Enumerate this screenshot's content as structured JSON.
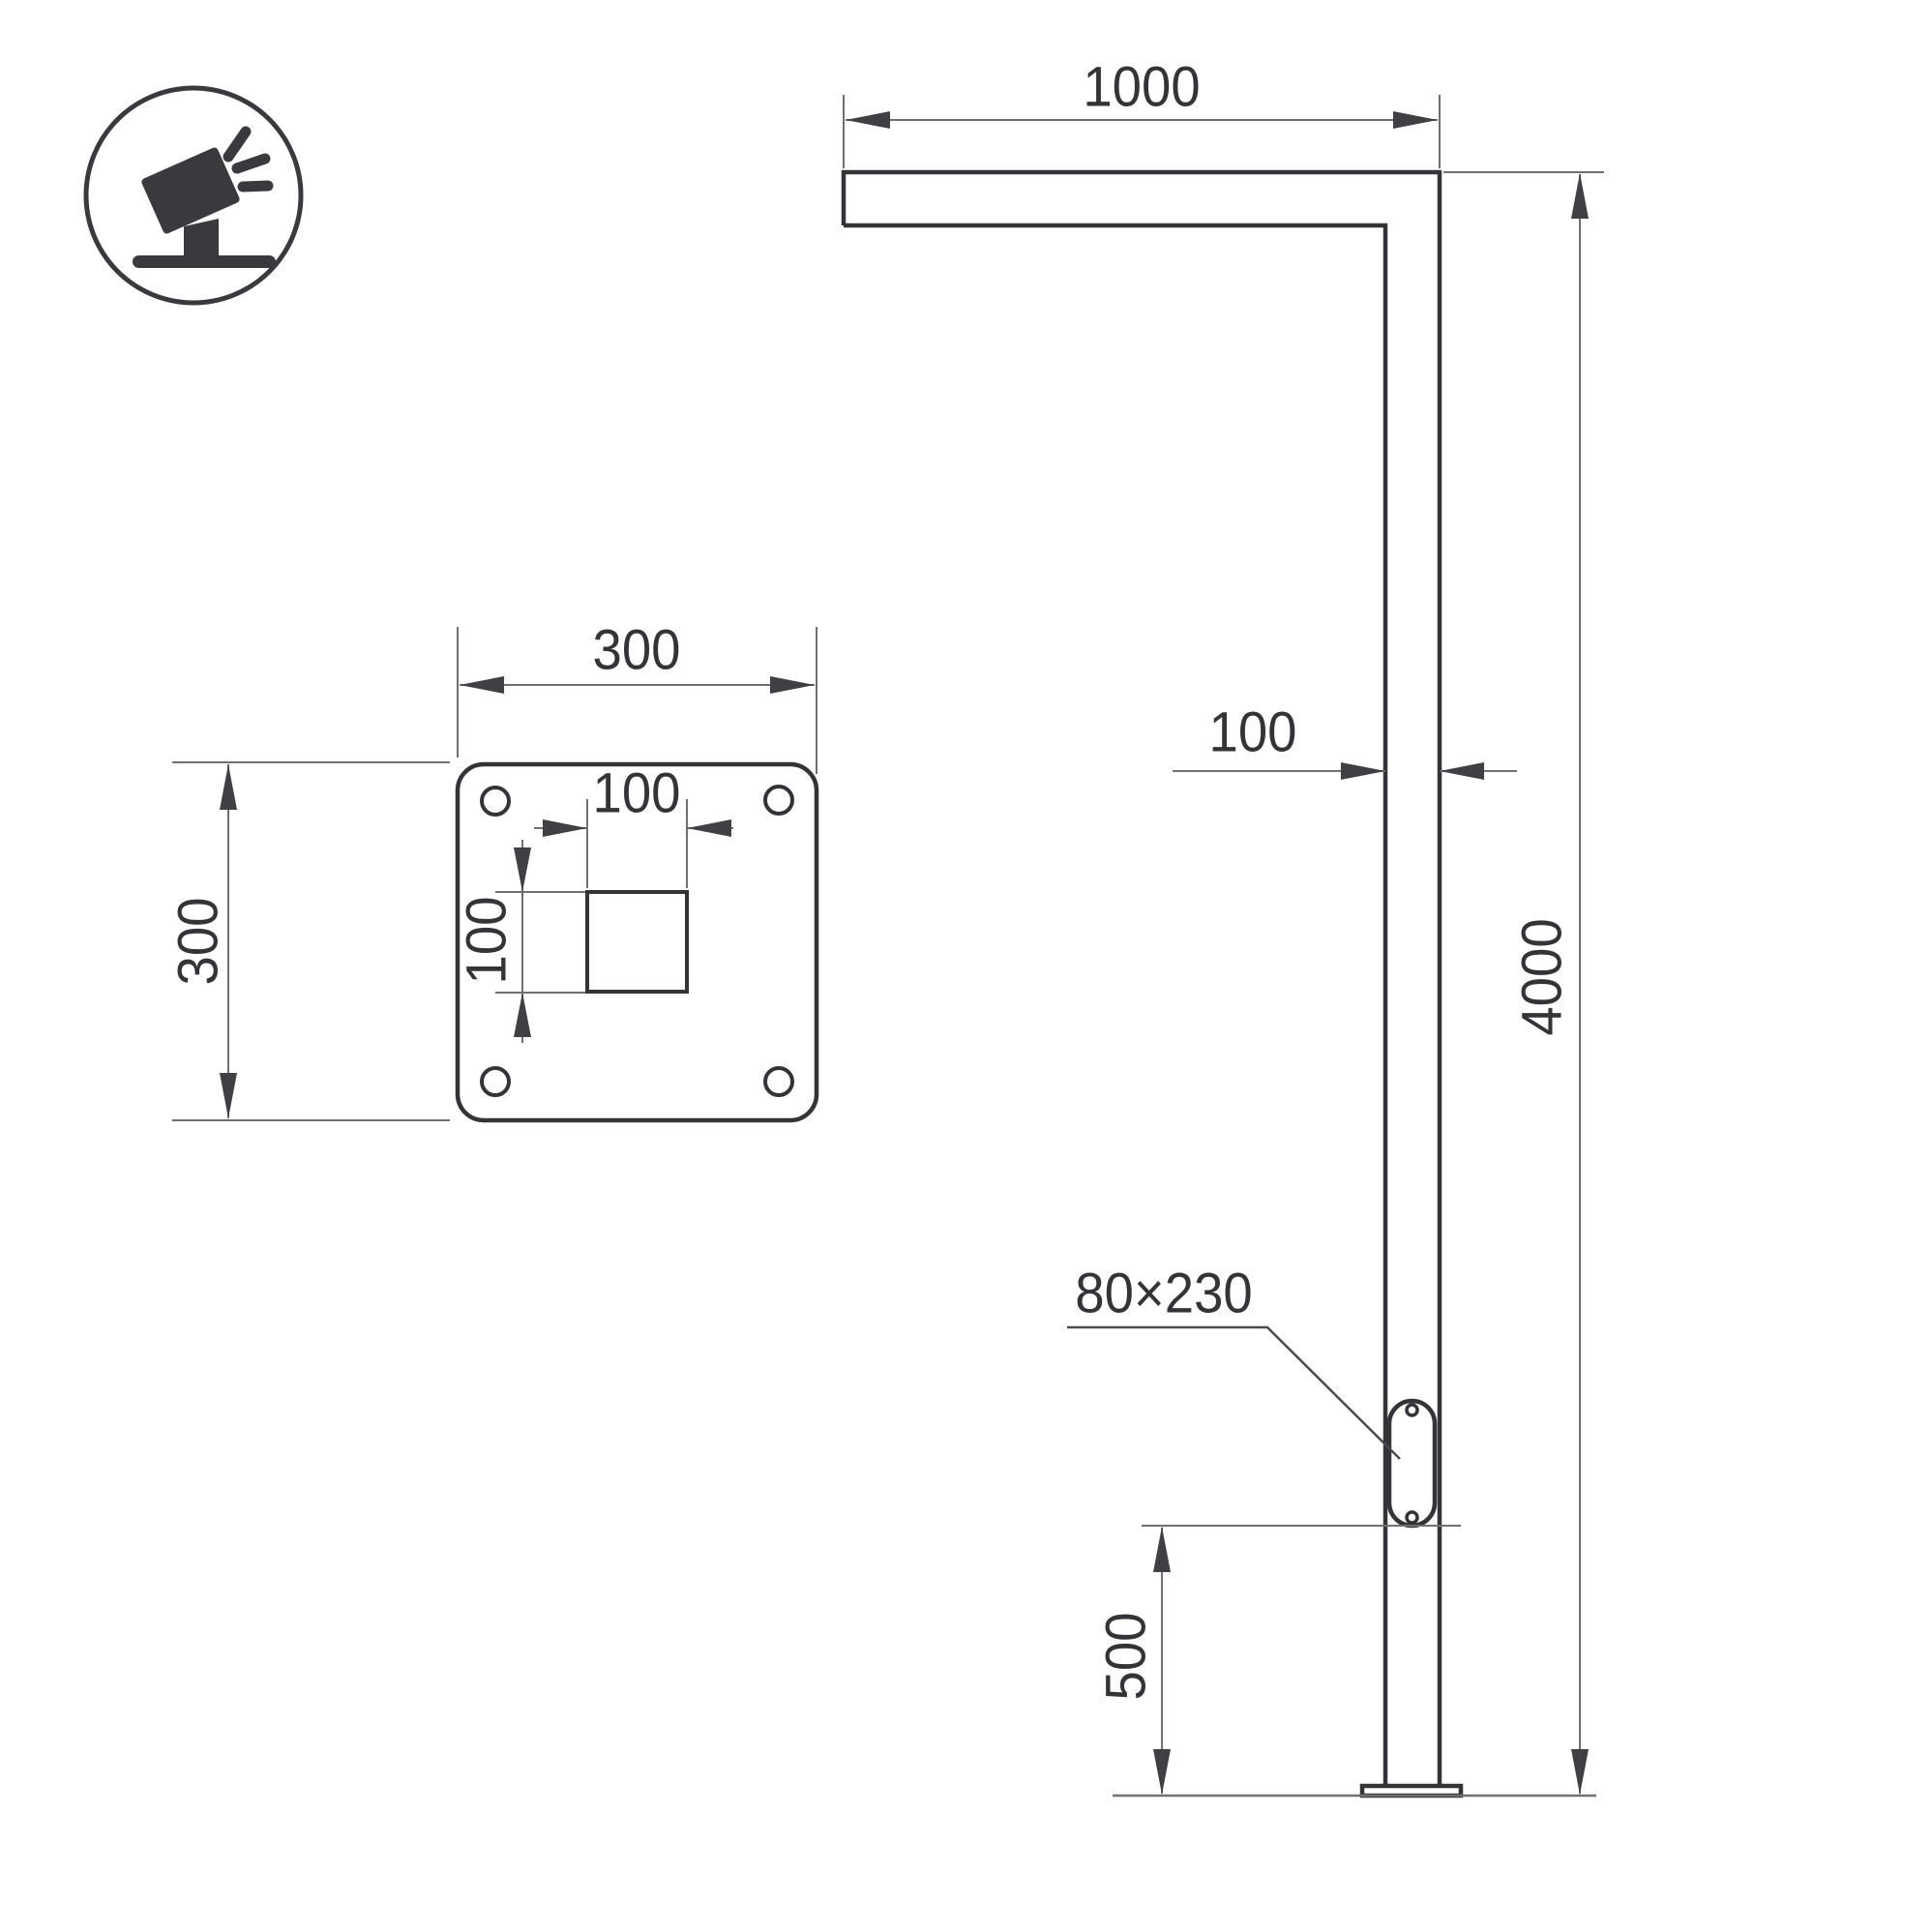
{
  "page": {
    "background": "#ffffff",
    "object_line_color": "#333338",
    "dimension_line_color": "#707070",
    "arrow_color": "#3f3f44",
    "text_color": "#343438"
  },
  "icon": {
    "name": "tilted-floodlight-icon",
    "description": "floodlight tilted on stand with light rays, inside circle"
  },
  "front_view": {
    "dimensions": {
      "arm_length": "1000",
      "pole_width": "100",
      "total_height": "4000",
      "door_size": "80×230",
      "door_bottom_offset": "500"
    }
  },
  "plate_view": {
    "dimensions": {
      "plate_width": "300",
      "plate_height": "300",
      "cutout_width": "100",
      "cutout_height": "100"
    }
  }
}
